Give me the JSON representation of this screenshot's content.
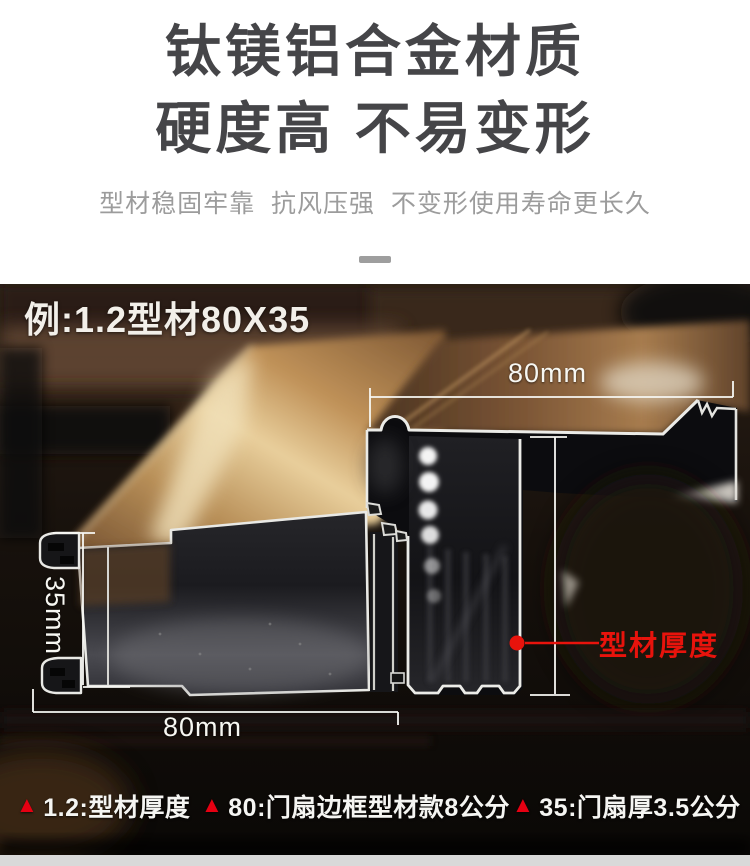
{
  "header": {
    "title_line1": "钛镁铝合金材质",
    "title_line2": "硬度高 不易变形",
    "subtitle": "型材稳固牢靠  抗风压强  不变形使用寿命更长久"
  },
  "photo": {
    "example_label": "例:1.2型材80X35",
    "dimensions": {
      "top_width": "80mm",
      "left_height": "35mm",
      "bottom_width": "80mm",
      "thickness_label": "型材厚度"
    },
    "captions": [
      {
        "marker": "▲",
        "text": "1.2:型材厚度"
      },
      {
        "marker": "▲",
        "text": "80:门扇边框型材款8公分"
      },
      {
        "marker": "▲",
        "text": "35:门扇厚3.5公分"
      }
    ]
  },
  "colors": {
    "accent_red": "#e8130c",
    "triangle_red": "#e60012",
    "title_gray": "#454548",
    "subtitle_gray": "#9c9c9c",
    "footer_strip_gray": "#d9d9d9"
  }
}
